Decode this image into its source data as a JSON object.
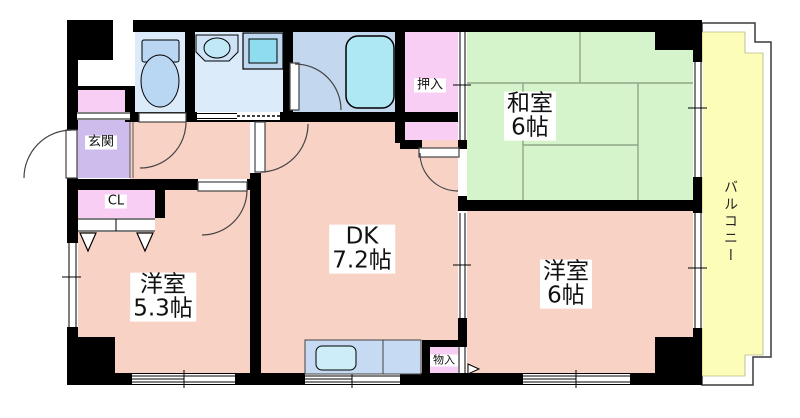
{
  "rooms": {
    "washitsu": {
      "name": "和室",
      "size": "6帖"
    },
    "dk": {
      "name": "DK",
      "size": "7.2帖"
    },
    "western_5_3": {
      "name": "洋室",
      "size": "5.3帖"
    },
    "western_6": {
      "name": "洋室",
      "size": "6帖"
    },
    "oshiire": {
      "name": "押入"
    },
    "genkan": {
      "name": "玄関"
    },
    "closet": {
      "name": "CL"
    },
    "monoire": {
      "name": "物入"
    },
    "balcony": {
      "name": "バルコニー"
    }
  },
  "fixtures": {
    "toilet": "toilet-icon",
    "washbasin": "washbasin-icon",
    "washing_machine_pan": "washing-machine-pan-icon",
    "bathtub": "bathtub-icon",
    "kitchen_sink": "kitchen-sink-icon"
  },
  "colors": {
    "room_pink": "#f8d2c5",
    "tatami_green": "#d6f4cb",
    "balcony_yellow": "#fdfdba",
    "storage_pink": "#f9cef5",
    "genkan_purple": "#cdbcec",
    "bathroom_blue": "#c3d7ef",
    "sanitary_blue": "#dcebfa",
    "fixture_teal": "#a9e5f2",
    "wall": "#000000"
  }
}
